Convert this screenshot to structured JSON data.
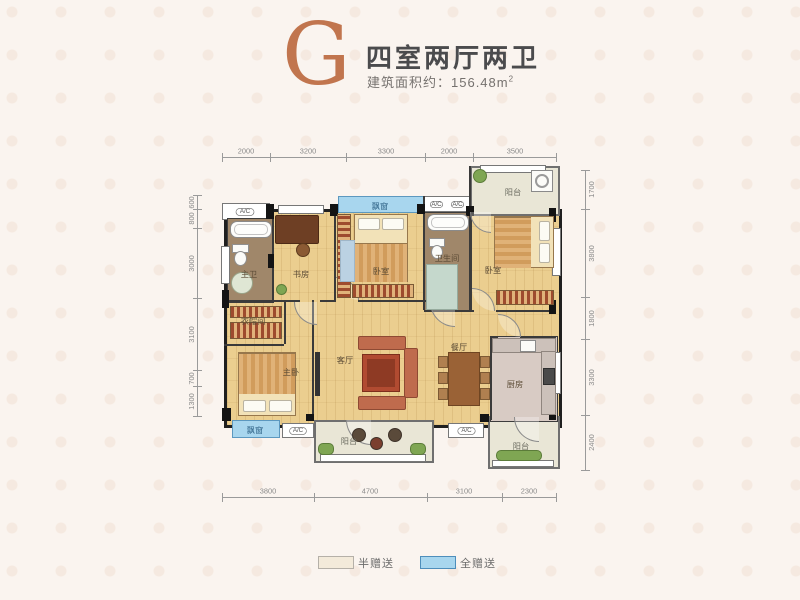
{
  "header": {
    "unit_type": "G",
    "title": "四室两厅两卫",
    "area_text": "建筑面积约：156.48m",
    "area_sup": "2"
  },
  "plan": {
    "ac_label": "A/C",
    "dims": {
      "top": [
        "2000",
        "3200",
        "3300",
        "2000",
        "3500"
      ],
      "bottom": [
        "3800",
        "4700",
        "3100",
        "2300"
      ],
      "left": [
        "600",
        "800",
        "3000",
        "3100",
        "700",
        "1300"
      ],
      "right": [
        "1700",
        "3800",
        "1800",
        "3300",
        "2400"
      ]
    },
    "rooms": {
      "master_bath": "主卫",
      "study": "书房",
      "bedroom_mid": "卧室",
      "bathroom": "卫生间",
      "bedroom_right": "卧室",
      "balcony_top": "阳台",
      "cloakroom": "衣帽间",
      "master_bedroom": "主卧",
      "living": "客厅",
      "dining": "餐厅",
      "kitchen": "厨房",
      "balcony_bottom": "阳台",
      "balcony_bottom_right": "阳台",
      "bay_window_top": "飘窗",
      "bay_window_bottom": "飘窗"
    }
  },
  "legend": {
    "half": {
      "label": "半赠送",
      "color": "#F3EADA"
    },
    "full": {
      "label": "全赠送",
      "color": "#A8D6EE"
    }
  }
}
